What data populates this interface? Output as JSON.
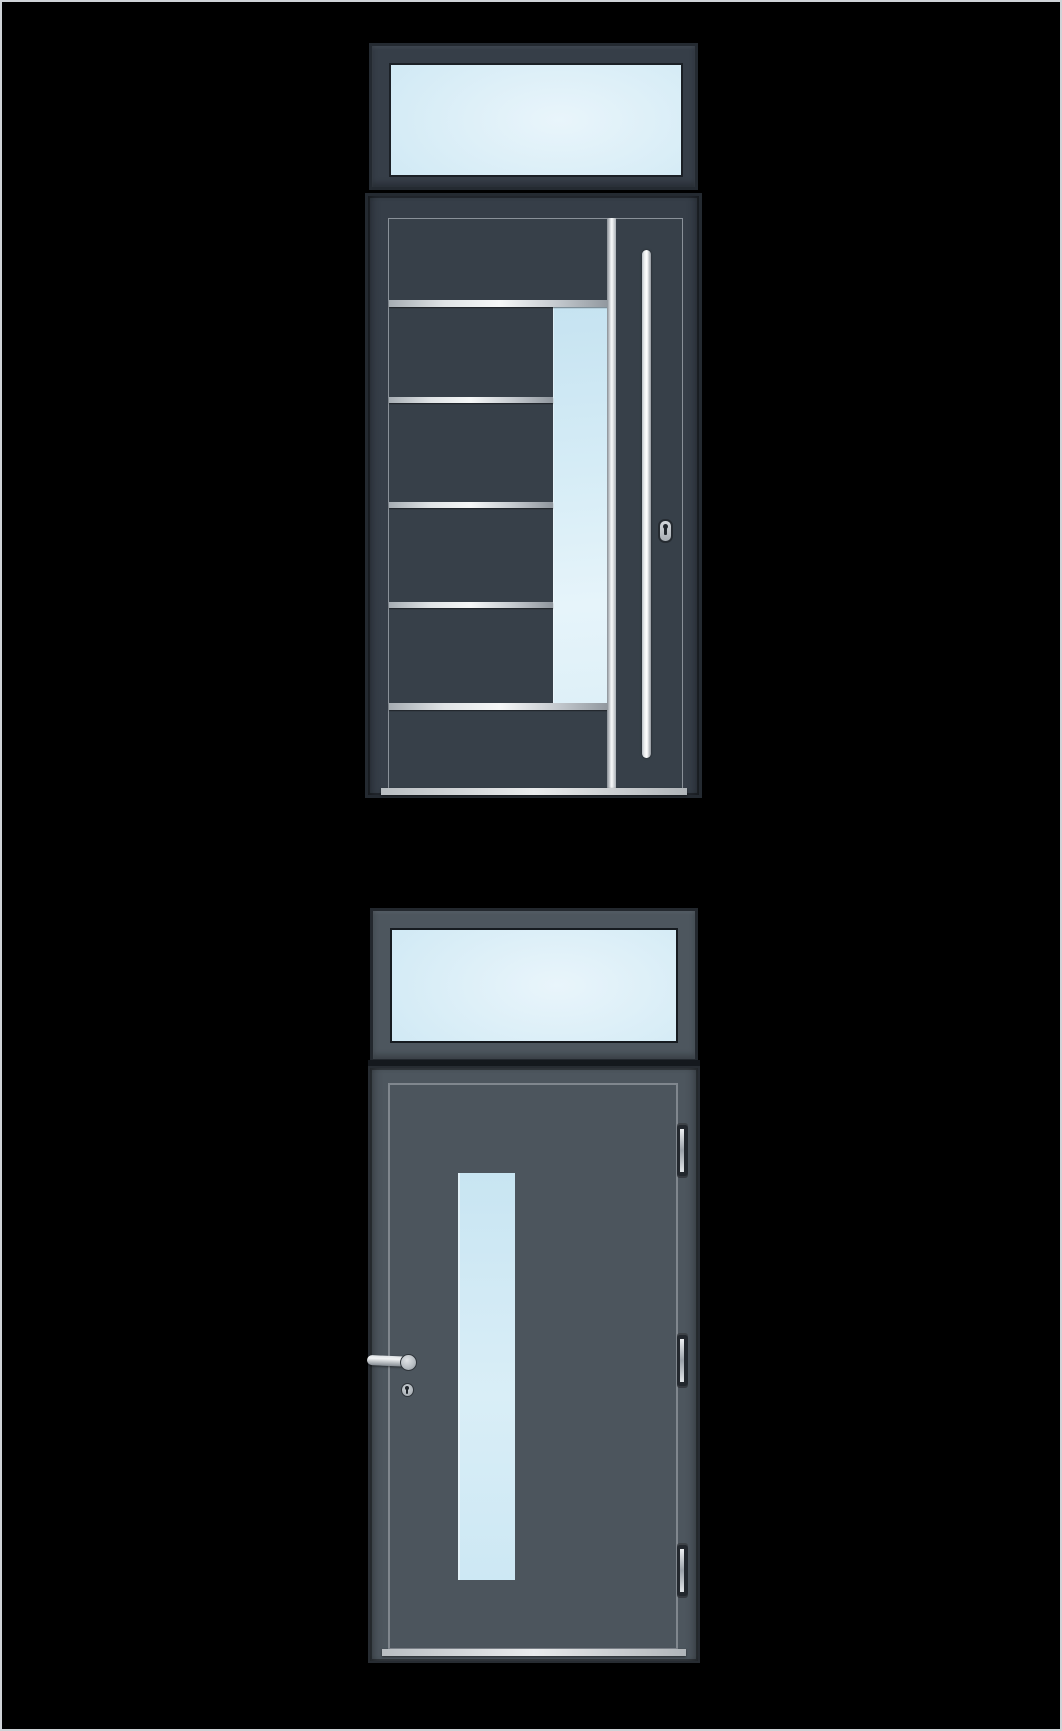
{
  "page": {
    "title": "Entry door product illustrations",
    "background_color": "#000000",
    "border_color": "#cfd3d7"
  },
  "theme": {
    "bg": "#000000",
    "canvas-border": "#cfd3d7",
    "a-frame": "#363e48",
    "a-leaf": "#374049",
    "a-edge": "#242a31",
    "g-frame": "#4d565e",
    "g-leaf": "#4c555d",
    "g-edge": "#23282e",
    "outline-light": "#99a0a7",
    "outline-light2": "#8d949b",
    "glass-dark-rim": "#1b2026",
    "glass-deep": "#bedff0",
    "glass-mid": "#d6ecf6",
    "glass-light": "#e9f5fb",
    "metal-dark": "#8f969d",
    "metal-mid": "#c6cbd0",
    "metal-light": "#f6f8f8",
    "handle-white": "#ffffff"
  },
  "doors": [
    {
      "name": "Anthracite entry door with transom window, five horizontal steel stripes, side glass strip and vertical bar pull handle",
      "finish_color": "#353d47",
      "parts": {
        "transom": "transom window",
        "stripe_count": 5,
        "glass_panel": "vertical side glazing",
        "handle": "vertical bar pull handle",
        "lock": "keyhole escutcheon"
      }
    },
    {
      "name": "Gray entry door with transom window, central vertical glass strip, lever handle, profile cylinder and three hinges",
      "finish_color": "#4d565e",
      "parts": {
        "transom": "transom window",
        "glass_panel": "central vertical glazing",
        "handle": "lever handle with rosette",
        "lock": "profile cylinder keyhole",
        "hinge_count": 3
      }
    }
  ]
}
